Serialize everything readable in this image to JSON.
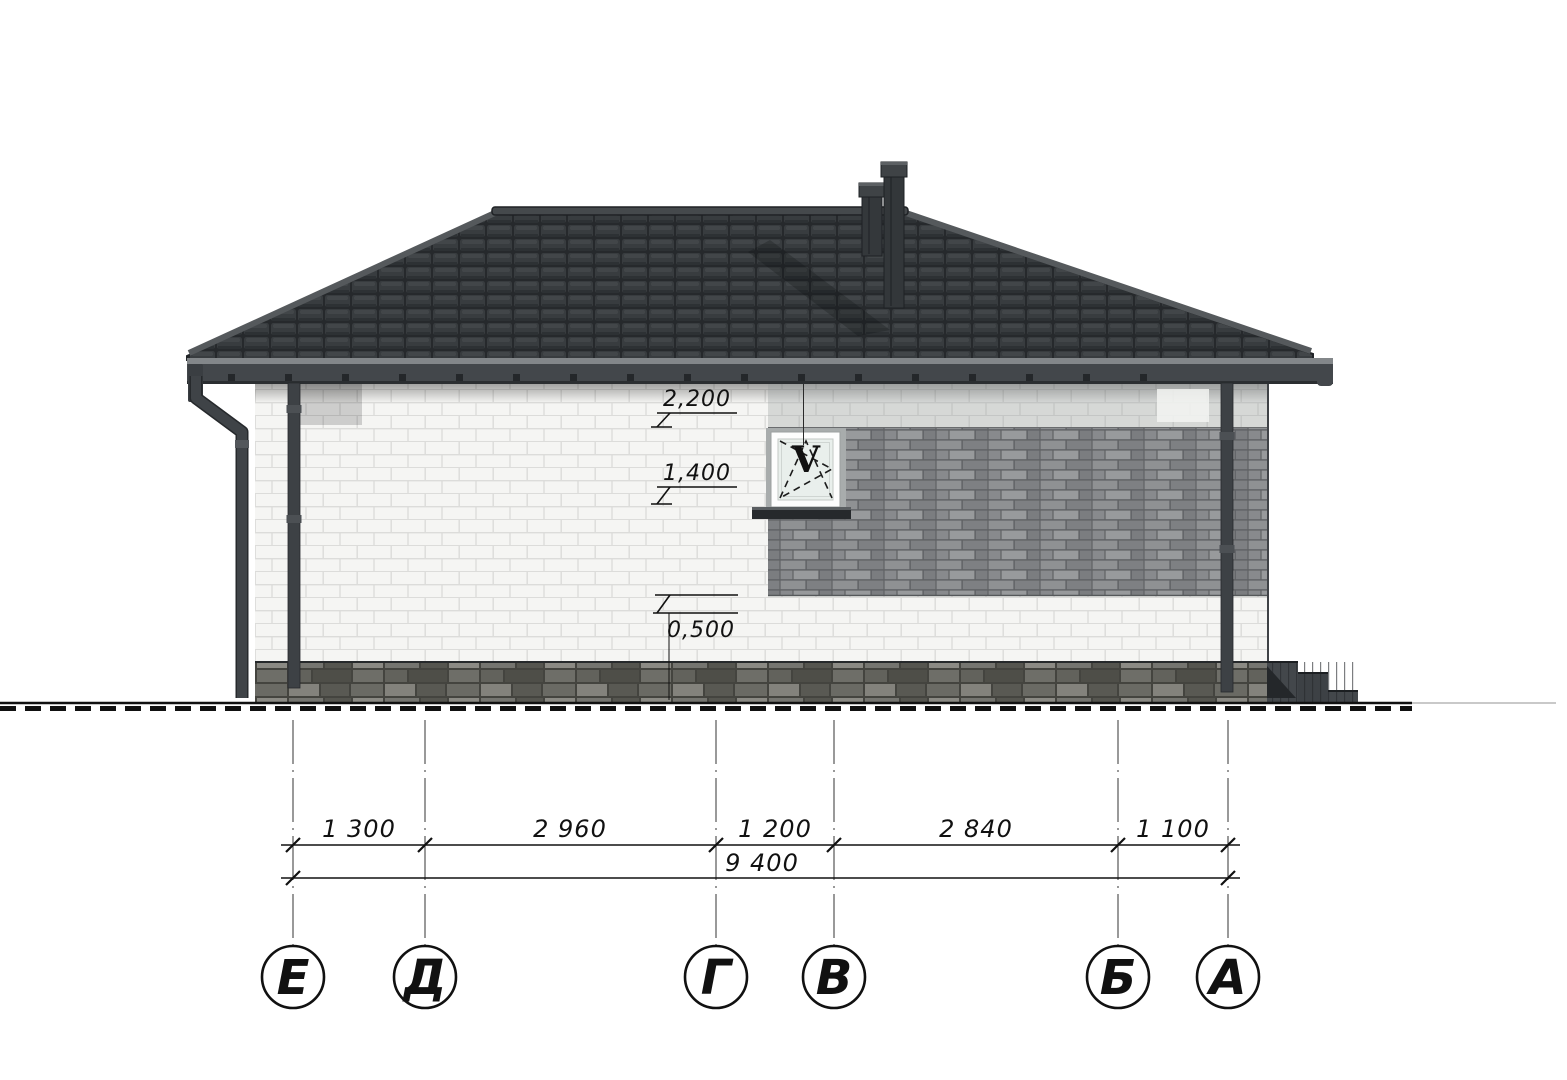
{
  "drawing": {
    "kind": "house-side-elevation",
    "window": {
      "mark": "V"
    },
    "levels": [
      "2,200",
      "1,400",
      "0,500"
    ],
    "dims": {
      "segments": [
        "1 300",
        "2 960",
        "1 200",
        "2 840",
        "1 100"
      ],
      "total": "9 400"
    },
    "axes": [
      "Е",
      "Д",
      "Г",
      "В",
      "Б",
      "А"
    ],
    "colors": {
      "roof_tile": "#34383b",
      "fascia": "#43474b",
      "white_brick": "#f5f5f3",
      "white_mortar": "#dcdcda",
      "gray_brick": "#85878a",
      "gray_mortar": "#5f6164",
      "plinth_stone": "#5a5a56",
      "pipe": "#3d4145",
      "glass": "#e9efec",
      "line": "#111111"
    }
  }
}
